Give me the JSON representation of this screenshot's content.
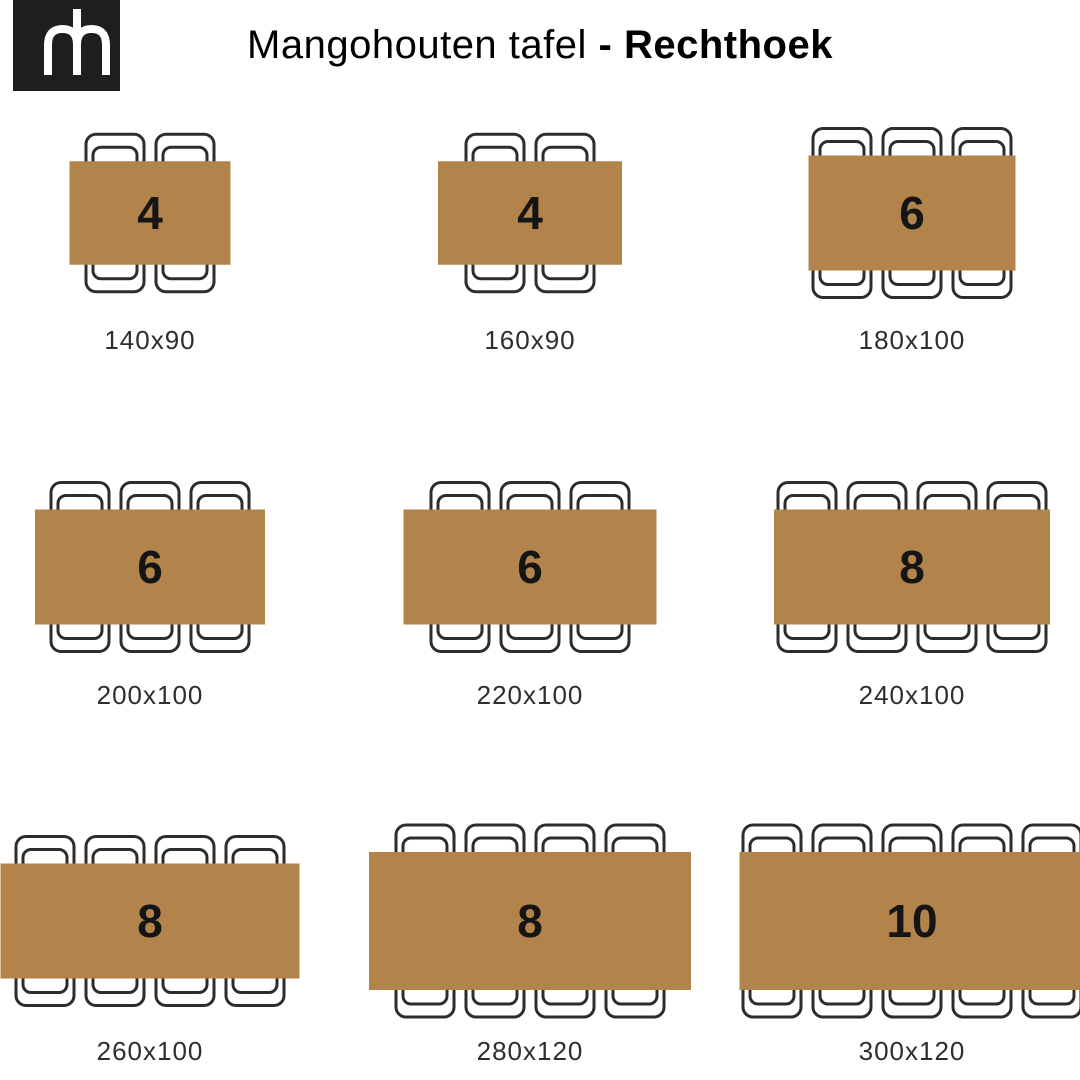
{
  "header": {
    "logo": {
      "monogram": "mh-monogram",
      "bg_color": "#201d1d",
      "mark_color": "#ffffff"
    },
    "title_regular": "Mangohouten tafel ",
    "title_bold": "- Rechthoek",
    "title_color": "#1b1b1b"
  },
  "diagram": {
    "table_color": "#b3834c",
    "chair_outline_color": "#2d2d2d",
    "seat_number_color": "#151515",
    "size_label_color": "#2e2e2e",
    "cells": [
      {
        "seats": "4",
        "label": "140x90",
        "width_cm": 140,
        "depth_cm": 90,
        "chairs_per_side": 2,
        "col": 0,
        "row": 0
      },
      {
        "seats": "4",
        "label": "160x90",
        "width_cm": 160,
        "depth_cm": 90,
        "chairs_per_side": 2,
        "col": 1,
        "row": 0
      },
      {
        "seats": "6",
        "label": "180x100",
        "width_cm": 180,
        "depth_cm": 100,
        "chairs_per_side": 3,
        "col": 2,
        "row": 0
      },
      {
        "seats": "6",
        "label": "200x100",
        "width_cm": 200,
        "depth_cm": 100,
        "chairs_per_side": 3,
        "col": 0,
        "row": 1
      },
      {
        "seats": "6",
        "label": "220x100",
        "width_cm": 220,
        "depth_cm": 100,
        "chairs_per_side": 3,
        "col": 1,
        "row": 1
      },
      {
        "seats": "8",
        "label": "240x100",
        "width_cm": 240,
        "depth_cm": 100,
        "chairs_per_side": 4,
        "col": 2,
        "row": 1
      },
      {
        "seats": "8",
        "label": "260x100",
        "width_cm": 260,
        "depth_cm": 100,
        "chairs_per_side": 4,
        "col": 0,
        "row": 2
      },
      {
        "seats": "8",
        "label": "280x120",
        "width_cm": 280,
        "depth_cm": 120,
        "chairs_per_side": 4,
        "col": 1,
        "row": 2
      },
      {
        "seats": "10",
        "label": "300x120",
        "width_cm": 300,
        "depth_cm": 120,
        "chairs_per_side": 5,
        "col": 2,
        "row": 2
      }
    ],
    "layout": {
      "px_per_cm": 1.15,
      "col_centers": [
        150,
        530,
        912
      ],
      "row_table_centers": [
        213,
        567,
        921
      ],
      "row_label_centers": [
        340,
        695,
        1051
      ]
    }
  }
}
